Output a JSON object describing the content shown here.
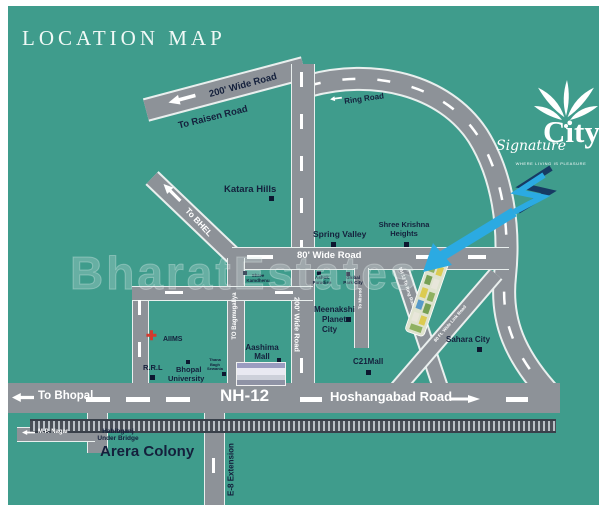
{
  "title": "LOCATION MAP",
  "watermark": "BharatEstates",
  "logo": {
    "script": "Signature",
    "name": "City",
    "tagline": "WHERE LIVING IS PLEASURE"
  },
  "roads": {
    "top200": "200' Wide Road",
    "raisen": "To Raisen Road",
    "ring": "Ring Road",
    "bhel": "To BHEL",
    "vert200": "200' Wide Road",
    "wide80": "80' Wide Road",
    "bagmugaliya": "TO Bagmugaliya",
    "misrod": "To Misrod",
    "link_left": "NH 12 To Ring Road Link Road",
    "link_right": "80 Ft. Wide Link Road",
    "nh12": "NH-12",
    "to_bhopal": "To Bhopal",
    "hoshangabad": "Hoshangabad Road",
    "e8": "E-8 Extension",
    "mp_nagar": "M.P. Nagar"
  },
  "places": {
    "katara": "Katara Hills",
    "spring": "Spring Valley",
    "shree_krishna_1": "Shree Krishna",
    "shree_krishna_2": "Heights",
    "meenakshi_1": "Meenakshi",
    "meenakshi_2": "Planet",
    "meenakshi_3": "City",
    "c21": "C21Mall",
    "sahara": "Sahara City",
    "kamdhenu_1": "Shree",
    "kamdhenu_2": "Kamdhenu",
    "ashok_1": "Ashok",
    "ashok_2": "Paradise",
    "global_1": "Global",
    "global_2": "Park City",
    "thana_1": "Thana",
    "thana_2": "Bagh",
    "thana_3": "Sewania",
    "rrl": "R.R.L",
    "aiims": "AIIMS",
    "univ_1": "Bhopal",
    "univ_2": "University",
    "aashima_1": "Aashima",
    "aashima_2": "Mall",
    "habibganj_1": "Habibganj",
    "habibganj_2": "Under Bridge",
    "arera": "Arera Colony"
  },
  "colors": {
    "background": "#3F9C8C",
    "road": "#8D9298",
    "dark_text": "#14203C",
    "arrow_blue": "#2BAAE2",
    "aiims_red": "#D43A2E"
  }
}
